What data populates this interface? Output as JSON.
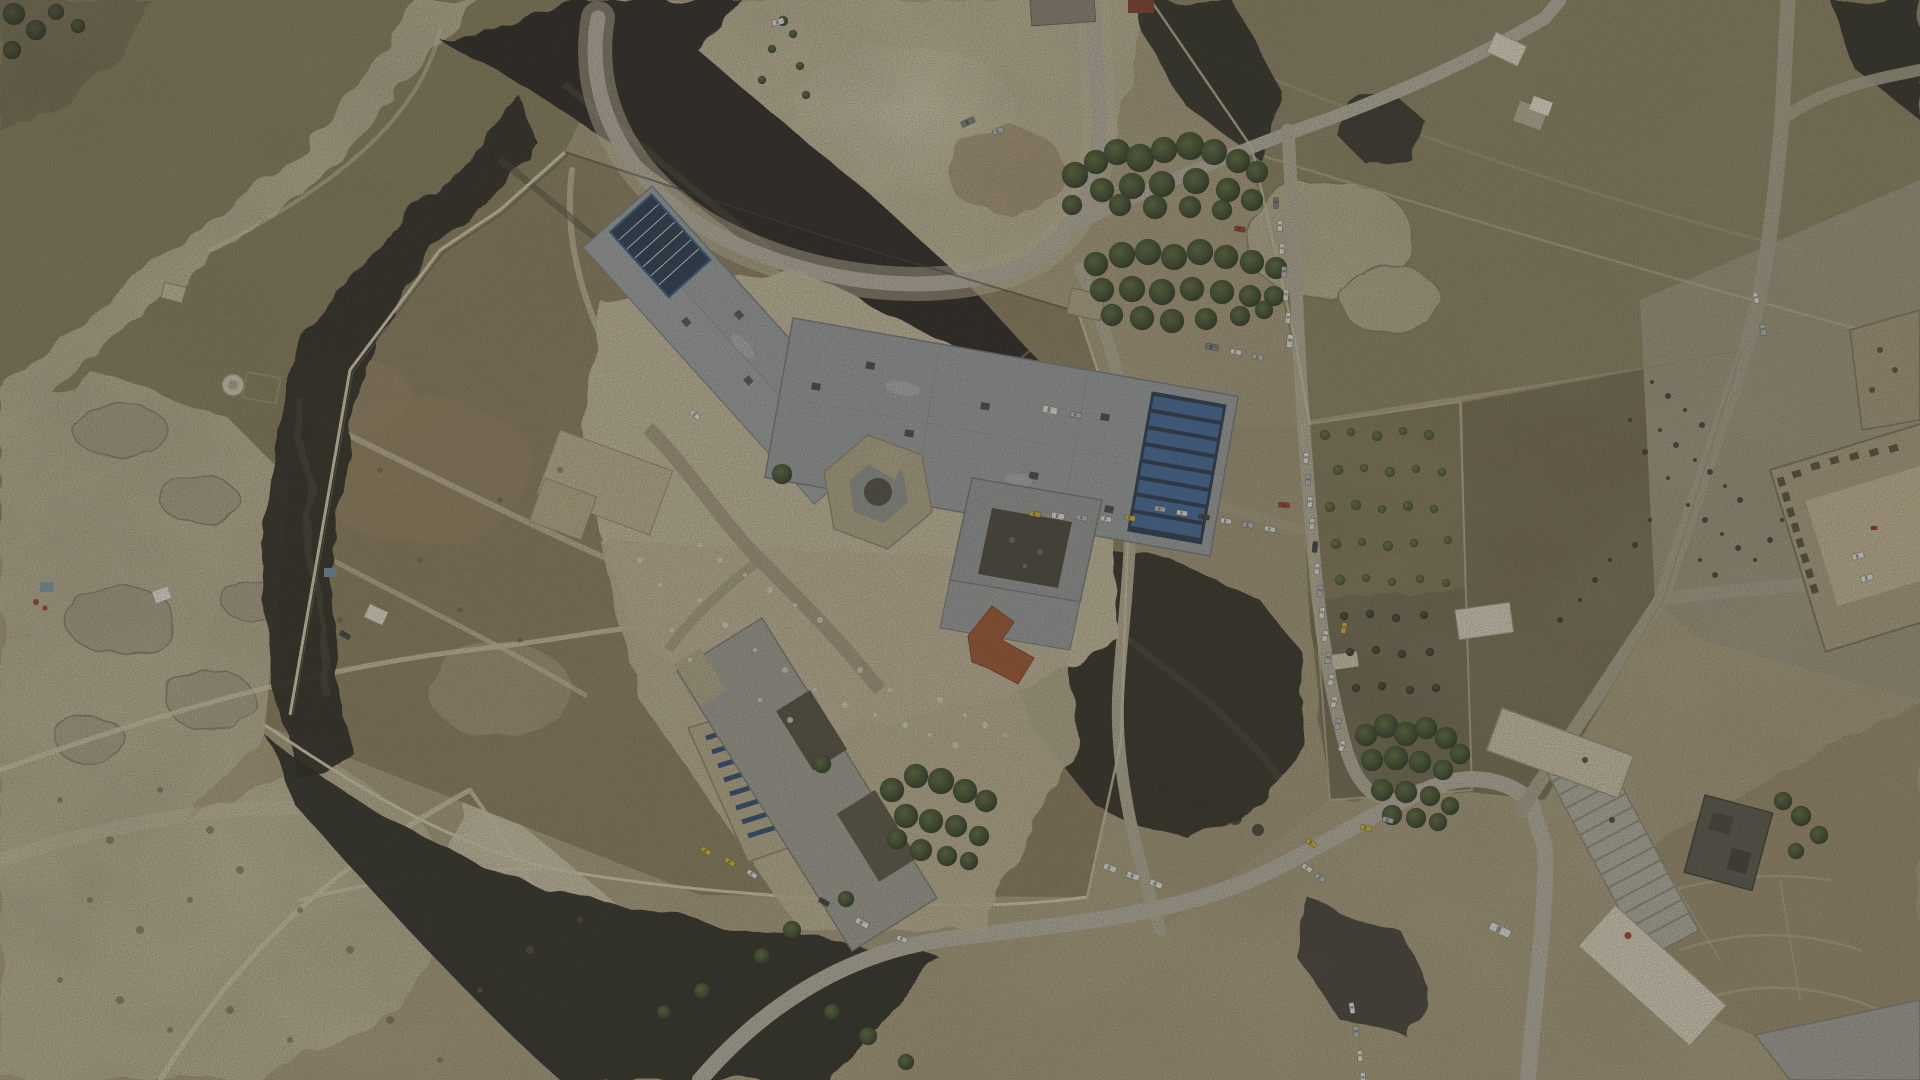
{
  "scene": {
    "kind": "aerial-drone-photograph",
    "subject": "walled desert prison compound with burned scrubland, roads and queued vehicles",
    "time_of_day": "overcast daylight"
  },
  "palette": {
    "ground_tan": "#b3a484",
    "scrub_olive": "#857a57",
    "field_olive": "#8b8160",
    "field_brown": "#72654a",
    "pale_rock": "#cfc4a6",
    "burn_black": "#211f1a",
    "burn_ash": "#4a453a",
    "roof_gray": "#9aa0a2",
    "roof_tan": "#c2b593",
    "roof_red": "#a0522f",
    "solar_blue": "#3a5c8c",
    "road_gray": "#b8b1a2",
    "tree_green": "#3f472a",
    "vehicle_colors": {
      "wh": "#e9e8e3",
      "sv": "#b9bdc0",
      "dk": "#3c3f42",
      "yl": "#d9b62e",
      "rd": "#a03828",
      "bl": "#4668a0",
      "gr": "#7a7f80"
    }
  },
  "counts": {
    "vehicles": 62,
    "trees": 140
  },
  "vehicles": [
    [
      1306,
      458,
      95,
      "wh"
    ],
    [
      1308,
      480,
      95,
      "sv"
    ],
    [
      1310,
      502,
      96,
      "wh"
    ],
    [
      1312,
      524,
      96,
      "wh"
    ],
    [
      1315,
      547,
      97,
      "dk"
    ],
    [
      1317,
      569,
      97,
      "wh"
    ],
    [
      1320,
      591,
      98,
      "sv"
    ],
    [
      1322,
      613,
      98,
      "wh"
    ],
    [
      1325,
      636,
      99,
      "wh"
    ],
    [
      1328,
      658,
      100,
      "sv"
    ],
    [
      1331,
      680,
      100,
      "wh"
    ],
    [
      1334,
      702,
      102,
      "wh"
    ],
    [
      1338,
      724,
      104,
      "sv"
    ],
    [
      1342,
      746,
      108,
      "wh"
    ],
    [
      1344,
      628,
      100,
      "yl"
    ],
    [
      1284,
      505,
      5,
      "rd"
    ],
    [
      1276,
      203,
      93,
      "gr"
    ],
    [
      1280,
      226,
      93,
      "wh"
    ],
    [
      1282,
      249,
      94,
      "wh"
    ],
    [
      1284,
      272,
      94,
      "sv"
    ],
    [
      1286,
      295,
      95,
      "wh"
    ],
    [
      1288,
      318,
      95,
      "wh"
    ],
    [
      1290,
      341,
      96,
      "wh",
      13,
      6
    ],
    [
      1240,
      229,
      10,
      "rd"
    ],
    [
      1160,
      509,
      8,
      "sv"
    ],
    [
      1182,
      513,
      9,
      "wh"
    ],
    [
      1204,
      517,
      9,
      "dk"
    ],
    [
      1226,
      521,
      10,
      "wh"
    ],
    [
      1248,
      525,
      10,
      "sv"
    ],
    [
      1270,
      529,
      11,
      "wh"
    ],
    [
      1035,
      514,
      10,
      "yl"
    ],
    [
      1058,
      516,
      10,
      "wh",
      13,
      6
    ],
    [
      1082,
      518,
      11,
      "sv"
    ],
    [
      1106,
      519,
      11,
      "wh"
    ],
    [
      1130,
      518,
      11,
      "yl"
    ],
    [
      1050,
      410,
      12,
      "wh",
      15,
      7
    ],
    [
      1076,
      415,
      12,
      "sv"
    ],
    [
      1212,
      347,
      10,
      "gr",
      13,
      6
    ],
    [
      1236,
      352,
      10,
      "wh"
    ],
    [
      1258,
      357,
      11,
      "sv"
    ],
    [
      706,
      851,
      35,
      "yl"
    ],
    [
      730,
      862,
      35,
      "yl"
    ],
    [
      752,
      874,
      35,
      "wh"
    ],
    [
      824,
      902,
      30,
      "dk"
    ],
    [
      862,
      923,
      28,
      "wh",
      14,
      6
    ],
    [
      902,
      939,
      20,
      "wh"
    ],
    [
      1110,
      868,
      20,
      "wh",
      13,
      6
    ],
    [
      1133,
      876,
      20,
      "wh",
      13,
      6
    ],
    [
      1156,
      884,
      22,
      "wh",
      13,
      6
    ],
    [
      1311,
      843,
      30,
      "yl"
    ],
    [
      1366,
      828,
      15,
      "yl"
    ],
    [
      1388,
      820,
      15,
      "sv"
    ],
    [
      1307,
      868,
      35,
      "wh"
    ],
    [
      1320,
      878,
      35,
      "sv"
    ],
    [
      1352,
      1008,
      80,
      "wh"
    ],
    [
      1356,
      1032,
      82,
      "sv"
    ],
    [
      1360,
      1056,
      84,
      "wh"
    ],
    [
      1363,
      1078,
      85,
      "wh"
    ],
    [
      1500,
      930,
      25,
      "wh",
      22,
      8
    ],
    [
      968,
      122,
      -24,
      "gr",
      14,
      6
    ],
    [
      998,
      131,
      -20,
      "sv"
    ],
    [
      778,
      22,
      -15,
      "wh",
      12,
      6
    ],
    [
      695,
      415,
      40,
      "wh"
    ],
    [
      345,
      635,
      30,
      "dk"
    ],
    [
      1858,
      556,
      -15,
      "wh",
      12,
      6
    ],
    [
      1867,
      578,
      -15,
      "wh",
      12,
      6
    ],
    [
      1874,
      528,
      0,
      "rd",
      6,
      4
    ],
    [
      1756,
      298,
      78,
      "wh"
    ],
    [
      1763,
      330,
      80,
      "sv"
    ]
  ],
  "trees": [
    [
      1075,
      175,
      13,
      "p"
    ],
    [
      1096,
      162,
      12,
      "p"
    ],
    [
      1117,
      152,
      13,
      "p"
    ],
    [
      1140,
      158,
      14,
      "p"
    ],
    [
      1164,
      150,
      13,
      "p"
    ],
    [
      1190,
      146,
      14,
      "p"
    ],
    [
      1214,
      152,
      13,
      "p"
    ],
    [
      1238,
      161,
      12,
      "p"
    ],
    [
      1257,
      172,
      11,
      "p"
    ],
    [
      1102,
      190,
      12,
      "p"
    ],
    [
      1132,
      186,
      13,
      "p"
    ],
    [
      1162,
      184,
      13,
      "p"
    ],
    [
      1196,
      181,
      13,
      "p"
    ],
    [
      1228,
      190,
      12,
      "p"
    ],
    [
      1252,
      200,
      11,
      "p"
    ],
    [
      1072,
      205,
      10,
      "p"
    ],
    [
      1120,
      205,
      11,
      "p"
    ],
    [
      1155,
      207,
      12,
      "p"
    ],
    [
      1190,
      207,
      11,
      "p"
    ],
    [
      1222,
      210,
      10,
      "p"
    ],
    [
      1096,
      264,
      12,
      "p"
    ],
    [
      1122,
      255,
      13,
      "p"
    ],
    [
      1148,
      252,
      13,
      "p"
    ],
    [
      1174,
      257,
      13,
      "p"
    ],
    [
      1200,
      252,
      13,
      "p"
    ],
    [
      1226,
      257,
      12,
      "p"
    ],
    [
      1252,
      262,
      12,
      "p"
    ],
    [
      1276,
      268,
      11,
      "p"
    ],
    [
      1102,
      290,
      12,
      "p"
    ],
    [
      1132,
      289,
      13,
      "p"
    ],
    [
      1162,
      292,
      13,
      "p"
    ],
    [
      1192,
      289,
      12,
      "p"
    ],
    [
      1222,
      292,
      12,
      "p"
    ],
    [
      1250,
      296,
      11,
      "p"
    ],
    [
      1274,
      296,
      10,
      "p"
    ],
    [
      1112,
      315,
      11,
      "p"
    ],
    [
      1142,
      318,
      12,
      "p"
    ],
    [
      1172,
      321,
      12,
      "p"
    ],
    [
      1206,
      319,
      11,
      "p"
    ],
    [
      1240,
      316,
      10,
      "p"
    ],
    [
      1264,
      310,
      9,
      "p"
    ],
    [
      1366,
      735,
      11,
      "p"
    ],
    [
      1386,
      726,
      12,
      "p"
    ],
    [
      1406,
      734,
      12,
      "p"
    ],
    [
      1426,
      728,
      11,
      "p"
    ],
    [
      1446,
      738,
      11,
      "p"
    ],
    [
      1460,
      754,
      10,
      "p"
    ],
    [
      1372,
      760,
      11,
      "p"
    ],
    [
      1396,
      758,
      12,
      "p"
    ],
    [
      1420,
      762,
      11,
      "p"
    ],
    [
      1443,
      770,
      10,
      "p"
    ],
    [
      1382,
      790,
      11,
      "p"
    ],
    [
      1406,
      792,
      11,
      "p"
    ],
    [
      1430,
      796,
      10,
      "p"
    ],
    [
      1450,
      806,
      9,
      "p"
    ],
    [
      1392,
      815,
      10,
      "p"
    ],
    [
      1416,
      818,
      10,
      "p"
    ],
    [
      1438,
      822,
      9,
      "p"
    ],
    [
      892,
      790,
      12,
      "p"
    ],
    [
      916,
      776,
      12,
      "p"
    ],
    [
      941,
      781,
      13,
      "p"
    ],
    [
      965,
      791,
      12,
      "p"
    ],
    [
      986,
      801,
      11,
      "p"
    ],
    [
      906,
      816,
      12,
      "p"
    ],
    [
      931,
      821,
      12,
      "p"
    ],
    [
      956,
      826,
      11,
      "p"
    ],
    [
      979,
      836,
      10,
      "p"
    ],
    [
      921,
      850,
      11,
      "p"
    ],
    [
      947,
      856,
      10,
      "p"
    ],
    [
      969,
      861,
      9,
      "p"
    ],
    [
      897,
      839,
      10,
      "p"
    ],
    [
      822,
      764,
      9,
      "p"
    ],
    [
      846,
      899,
      8,
      "p"
    ],
    [
      792,
      930,
      9,
      "p"
    ],
    [
      762,
      956,
      8,
      "p"
    ],
    [
      702,
      991,
      8,
      "p"
    ],
    [
      664,
      1012,
      7,
      "p"
    ],
    [
      832,
      1012,
      8,
      "p"
    ],
    [
      868,
      1036,
      9,
      "p"
    ],
    [
      906,
      1062,
      8,
      "p"
    ],
    [
      782,
      474,
      10,
      "p"
    ],
    [
      783,
      21,
      5,
      "p"
    ],
    [
      793,
      34,
      4,
      "p"
    ],
    [
      772,
      49,
      4,
      "p"
    ],
    [
      800,
      66,
      4,
      "p"
    ],
    [
      762,
      80,
      4,
      "p"
    ],
    [
      806,
      95,
      4,
      "p"
    ],
    [
      1783,
      801,
      9,
      "p"
    ],
    [
      1801,
      816,
      10,
      "p"
    ],
    [
      1819,
      835,
      9,
      "p"
    ],
    [
      1796,
      851,
      8,
      "p"
    ],
    [
      14,
      14,
      11,
      "d"
    ],
    [
      36,
      30,
      10,
      "d"
    ],
    [
      12,
      50,
      9,
      "d"
    ],
    [
      56,
      12,
      8,
      "d"
    ],
    [
      78,
      26,
      7,
      "d"
    ],
    [
      1325,
      435,
      5,
      "o"
    ],
    [
      1351,
      432,
      4,
      "o"
    ],
    [
      1377,
      436,
      5,
      "o"
    ],
    [
      1403,
      431,
      4,
      "o"
    ],
    [
      1429,
      435,
      5,
      "o"
    ],
    [
      1338,
      470,
      5,
      "o"
    ],
    [
      1364,
      468,
      4,
      "o"
    ],
    [
      1390,
      472,
      5,
      "o"
    ],
    [
      1416,
      469,
      4,
      "o"
    ],
    [
      1442,
      472,
      4,
      "o"
    ],
    [
      1330,
      507,
      5,
      "o"
    ],
    [
      1356,
      505,
      5,
      "o"
    ],
    [
      1382,
      509,
      4,
      "o"
    ],
    [
      1408,
      506,
      5,
      "o"
    ],
    [
      1434,
      509,
      4,
      "o"
    ],
    [
      1448,
      540,
      4,
      "o"
    ],
    [
      1336,
      544,
      5,
      "o"
    ],
    [
      1362,
      542,
      4,
      "o"
    ],
    [
      1388,
      546,
      5,
      "o"
    ],
    [
      1414,
      543,
      4,
      "o"
    ],
    [
      1340,
      580,
      5,
      "o"
    ],
    [
      1366,
      578,
      4,
      "o"
    ],
    [
      1392,
      582,
      4,
      "o"
    ],
    [
      1420,
      579,
      4,
      "o"
    ],
    [
      1446,
      583,
      4,
      "o"
    ],
    [
      1344,
      616,
      4,
      "b"
    ],
    [
      1370,
      614,
      4,
      "b"
    ],
    [
      1396,
      618,
      4,
      "b"
    ],
    [
      1424,
      615,
      4,
      "b"
    ],
    [
      1350,
      652,
      4,
      "b"
    ],
    [
      1376,
      650,
      4,
      "b"
    ],
    [
      1402,
      654,
      4,
      "b"
    ],
    [
      1430,
      652,
      4,
      "b"
    ],
    [
      1356,
      688,
      4,
      "b"
    ],
    [
      1382,
      686,
      4,
      "b"
    ],
    [
      1410,
      690,
      4,
      "b"
    ],
    [
      1436,
      688,
      4,
      "b"
    ]
  ],
  "shrubs": [
    [
      60,
      800,
      3
    ],
    [
      110,
      840,
      4
    ],
    [
      160,
      790,
      3
    ],
    [
      210,
      830,
      4
    ],
    [
      90,
      900,
      3
    ],
    [
      140,
      930,
      4
    ],
    [
      190,
      900,
      3
    ],
    [
      240,
      870,
      4
    ],
    [
      300,
      910,
      3
    ],
    [
      350,
      950,
      4
    ],
    [
      60,
      980,
      3
    ],
    [
      120,
      1000,
      4
    ],
    [
      170,
      1030,
      3
    ],
    [
      230,
      1010,
      4
    ],
    [
      290,
      1040,
      3
    ],
    [
      390,
      1020,
      4
    ],
    [
      440,
      1060,
      3
    ],
    [
      480,
      990,
      3
    ],
    [
      530,
      950,
      4
    ],
    [
      580,
      920,
      3
    ],
    [
      420,
      560,
      3
    ],
    [
      460,
      610,
      3
    ],
    [
      500,
      500,
      3
    ],
    [
      560,
      470,
      3
    ],
    [
      380,
      470,
      3
    ],
    [
      340,
      620,
      3
    ],
    [
      520,
      640,
      3
    ]
  ],
  "debris_dark": [
    [
      1652,
      382,
      2
    ],
    [
      1668,
      396,
      3
    ],
    [
      1685,
      410,
      2
    ],
    [
      1702,
      425,
      3
    ],
    [
      1660,
      430,
      2
    ],
    [
      1676,
      445,
      3
    ],
    [
      1695,
      460,
      2
    ],
    [
      1710,
      472,
      3
    ],
    [
      1725,
      486,
      2
    ],
    [
      1740,
      500,
      3
    ],
    [
      1688,
      505,
      2
    ],
    [
      1705,
      520,
      3
    ],
    [
      1722,
      534,
      2
    ],
    [
      1738,
      548,
      3
    ],
    [
      1755,
      560,
      2
    ],
    [
      1668,
      478,
      2
    ],
    [
      1645,
      452,
      3
    ],
    [
      1630,
      420,
      2
    ],
    [
      1770,
      540,
      3
    ],
    [
      1782,
      520,
      2
    ],
    [
      1650,
      520,
      2
    ],
    [
      1635,
      545,
      3
    ],
    [
      1700,
      560,
      2
    ],
    [
      1715,
      575,
      3
    ],
    [
      1610,
      560,
      2
    ],
    [
      1595,
      580,
      3
    ],
    [
      1580,
      600,
      2
    ],
    [
      1560,
      620,
      3
    ],
    [
      1165,
      790,
      7
    ],
    [
      1200,
      805,
      8
    ],
    [
      1235,
      818,
      7
    ],
    [
      1258,
      830,
      6
    ],
    [
      1612,
      820,
      3
    ],
    [
      1585,
      760,
      3
    ]
  ],
  "debris_light": [
    [
      700,
      545,
      2
    ],
    [
      720,
      560,
      3
    ],
    [
      745,
      575,
      2
    ],
    [
      770,
      590,
      3
    ],
    [
      795,
      605,
      2
    ],
    [
      820,
      620,
      3
    ],
    [
      700,
      600,
      2
    ],
    [
      725,
      625,
      3
    ],
    [
      755,
      650,
      2
    ],
    [
      785,
      670,
      3
    ],
    [
      815,
      690,
      2
    ],
    [
      845,
      705,
      3
    ],
    [
      875,
      715,
      2
    ],
    [
      905,
      725,
      3
    ],
    [
      930,
      735,
      2
    ],
    [
      955,
      745,
      3
    ],
    [
      760,
      700,
      2
    ],
    [
      790,
      720,
      3
    ],
    [
      690,
      660,
      2
    ],
    [
      672,
      630,
      2
    ],
    [
      940,
      700,
      3
    ],
    [
      965,
      715,
      2
    ],
    [
      985,
      725,
      3
    ],
    [
      1005,
      735,
      2
    ],
    [
      860,
      670,
      3
    ],
    [
      890,
      690,
      2
    ],
    [
      640,
      560,
      3
    ],
    [
      660,
      585,
      2
    ]
  ]
}
